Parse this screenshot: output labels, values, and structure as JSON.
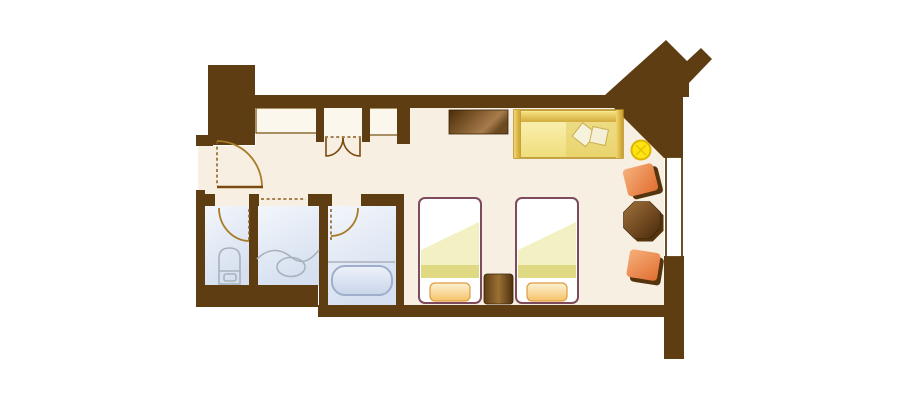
{
  "plan": {
    "title": "Hotel guest room floor plan",
    "rooms": [
      {
        "name": "entry-hall",
        "label": "Entry"
      },
      {
        "name": "toilet-room",
        "label": "Toilet room"
      },
      {
        "name": "vanity-room",
        "label": "Washbasin / vanity"
      },
      {
        "name": "bathroom",
        "label": "Bathroom with tub"
      },
      {
        "name": "closet",
        "label": "Bifold-door closet"
      },
      {
        "name": "luggage-rack",
        "label": "Luggage / counter nook"
      },
      {
        "name": "alcove",
        "label": "Alcove"
      },
      {
        "name": "bedroom",
        "label": "Main bedroom / living area"
      }
    ],
    "doors": [
      {
        "name": "entry-door",
        "type": "swing"
      },
      {
        "name": "toilet-door",
        "type": "swing"
      },
      {
        "name": "bathroom-door",
        "type": "swing"
      },
      {
        "name": "closet-doors",
        "type": "double-bifold"
      }
    ],
    "windows": [
      {
        "name": "right-window",
        "wall": "right"
      }
    ],
    "furniture": [
      {
        "name": "dresser",
        "label": "Dresser / TV counter"
      },
      {
        "name": "sofa",
        "label": "Sofa with two cushions"
      },
      {
        "name": "floor-lamp",
        "label": "Round lamp / stool"
      },
      {
        "name": "lounge-chair-1",
        "label": "Lounge chair"
      },
      {
        "name": "side-table",
        "label": "Octagonal side table"
      },
      {
        "name": "lounge-chair-2",
        "label": "Lounge chair"
      },
      {
        "name": "bed-1",
        "label": "Twin bed with pillow"
      },
      {
        "name": "bed-2",
        "label": "Twin bed with pillow"
      },
      {
        "name": "nightstand",
        "label": "Nightstand"
      },
      {
        "name": "toilet",
        "label": "Toilet"
      },
      {
        "name": "washbasin",
        "label": "Counter with oval basin"
      },
      {
        "name": "bathtub",
        "label": "Bathtub"
      }
    ]
  },
  "colors": {
    "wall": "#5D3D11",
    "floor": "#F8EFE3",
    "closet_floor": "#FCF7EC",
    "window": "#FFFFFF",
    "bed_base": "#FFFFFF",
    "bed_frame": "#7E4A5E",
    "bed_sheen": "#F2F0BE",
    "bed_blanket": "#DFD983",
    "lamp": "#FFE312",
    "lamp_rim": "#DDB500",
    "fixture_line": "#A9B2BC",
    "fixture_fill": "#F8FBFD",
    "shadow": "#53340D"
  }
}
